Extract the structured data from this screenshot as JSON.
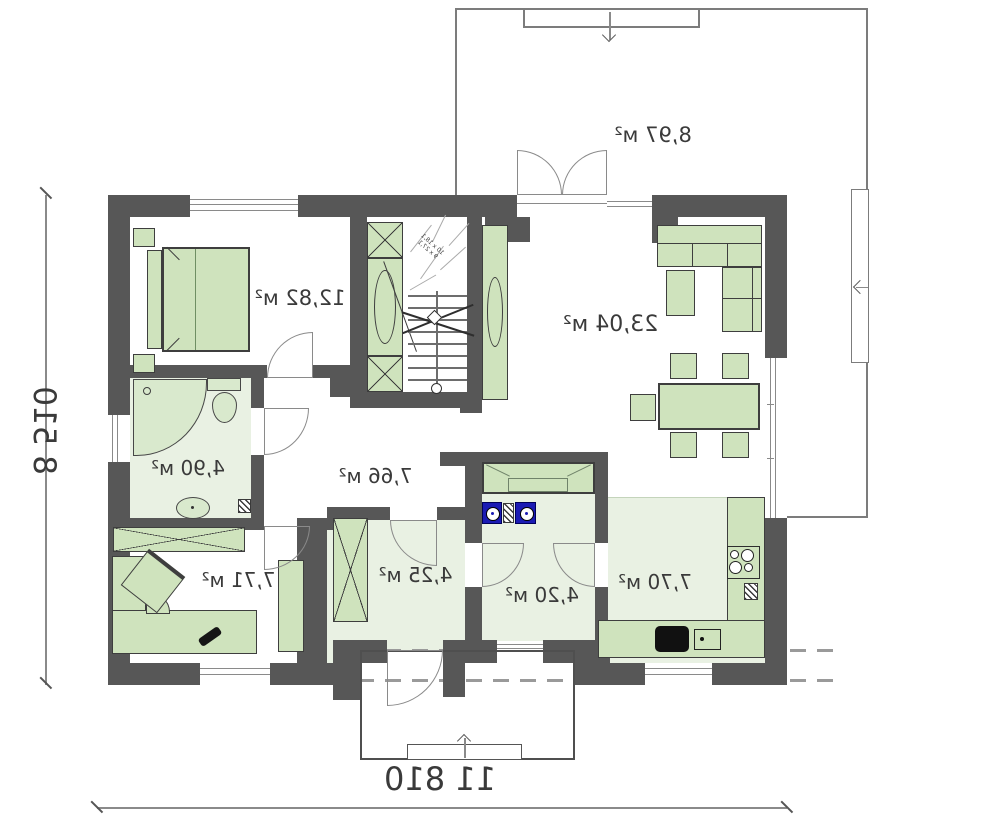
{
  "plan": {
    "rooms": [
      {
        "key": "bedroom",
        "area_label": "12,82 м²"
      },
      {
        "key": "terrace",
        "area_label": "8,97 м²"
      },
      {
        "key": "living_room",
        "area_label": "23,04 м²"
      },
      {
        "key": "bathroom",
        "area_label": "4,90 м²"
      },
      {
        "key": "hallway",
        "area_label": "7,66 м²"
      },
      {
        "key": "office",
        "area_label": "7,71 м²"
      },
      {
        "key": "vestibule",
        "area_label": "4,25 м²"
      },
      {
        "key": "laundry_wc",
        "area_label": "4,20 м²"
      },
      {
        "key": "kitchen",
        "area_label": "7,70 м²"
      }
    ],
    "dimensions": {
      "overall_width": "11 810",
      "overall_height": "8 510"
    },
    "stairs": {
      "note_line1": "10 х 18,1",
      "note_line2": "9 х 27,1"
    },
    "orientation": {
      "mirrored_text": true
    },
    "colors": {
      "wall": "#575757",
      "furniture_fill": "#cfe3bd",
      "wet_floor": "#e9f1e3",
      "appliance_blue": "#1b1bb4",
      "outline": "#7c7c7c"
    }
  }
}
